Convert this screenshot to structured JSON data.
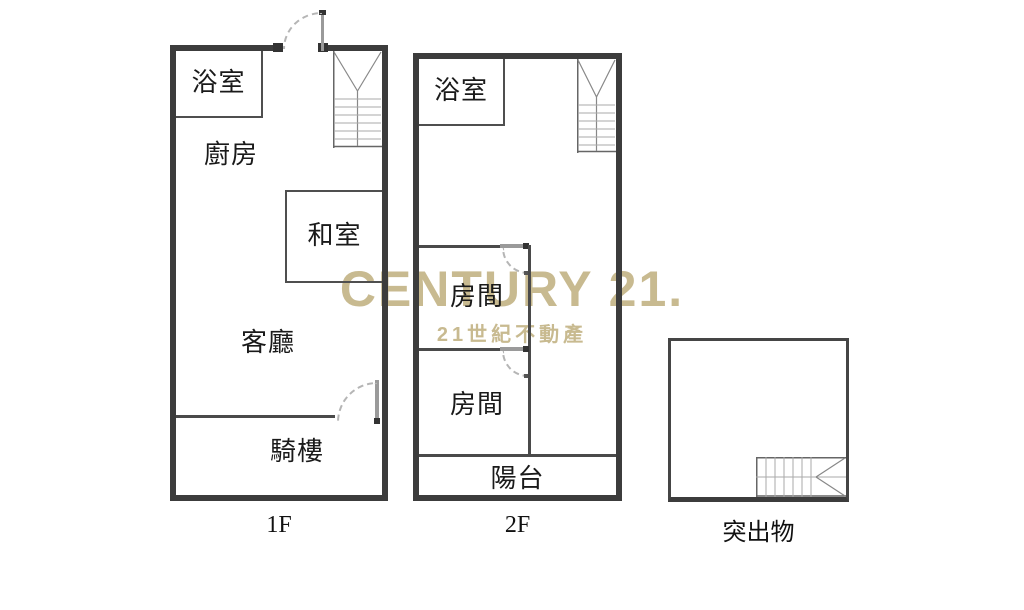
{
  "watermark": {
    "brand": "CENTURY 21.",
    "tagline": "21世紀不動產",
    "color": "#C8BA90"
  },
  "floor1": {
    "label": "1F",
    "bathroom": "浴室",
    "kitchen": "廚房",
    "tatami_room": "和室",
    "living_room": "客廳",
    "arcade": "騎樓"
  },
  "floor2": {
    "label": "2F",
    "bathroom": "浴室",
    "room_upper": "房間",
    "room_lower": "房間",
    "balcony": "陽台"
  },
  "protrusion": {
    "label": "突出物"
  },
  "colors": {
    "outer_wall": "#3C3C3C",
    "inner_wall": "#4A4A4A",
    "door_leaf": "#9A9A9A",
    "stair_lines": "#999999"
  }
}
